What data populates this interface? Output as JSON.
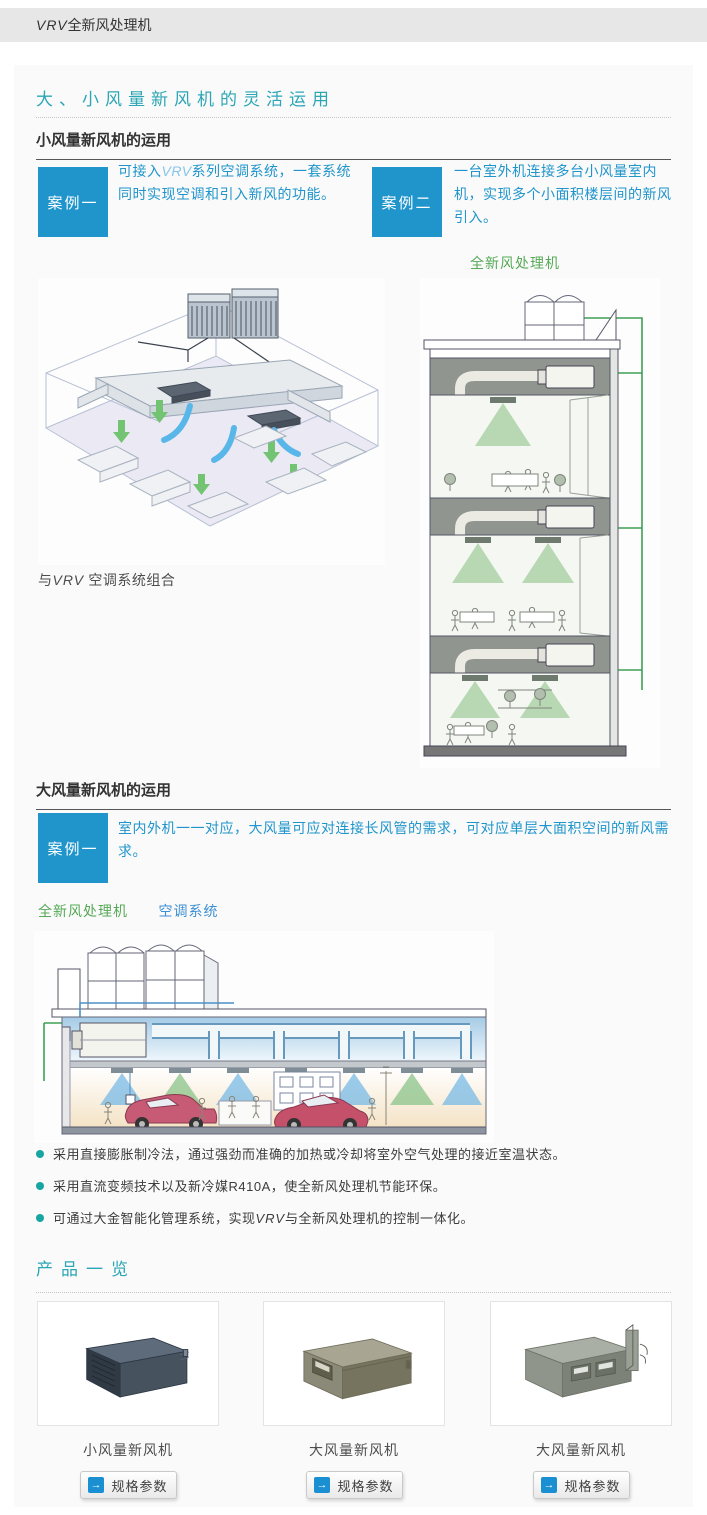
{
  "header": {
    "brand": "VRV",
    "title_rest": "全新风处理机"
  },
  "colors": {
    "accent_teal": "#2ca6b5",
    "case_blue": "#2095cc",
    "label_green": "#57a957",
    "label_blue": "#3c8fd2",
    "bullet_teal": "#18a5a2",
    "topbar_bg": "#e7e7e7",
    "card_bg": "#fafafa",
    "button_icon_blue": "#1a8fd1"
  },
  "icons": {
    "arrow_right": "→"
  },
  "main": {
    "title": "大、小风量新风机的灵活运用",
    "section_small": {
      "heading": "小风量新风机的运用",
      "case1": {
        "label": "案例一",
        "text_prefix": "可接入",
        "text_brand": "VRV",
        "text_suffix": "系列空调系统，一套系统同时实现空调和引入新风的功能。"
      },
      "case2": {
        "label": "案例二",
        "text": "一台室外机连接多台小风量室内机，实现多个小面积楼层间的新风引入。"
      },
      "building_label": "全新风处理机",
      "office_caption_prefix": "与",
      "office_caption_brand": "VRV",
      "office_caption_suffix": " 空调系统组合"
    },
    "section_large": {
      "heading": "大风量新风机的运用",
      "case1": {
        "label": "案例一",
        "text": "室内外机一一对应，大风量可应对连接长风管的需求，可对应单层大面积空间的新风需求。"
      },
      "labels": {
        "fresh_air": "全新风处理机",
        "ac_system": "空调系统"
      }
    },
    "bullets": [
      {
        "text": "采用直接膨胀制冷法，通过强劲而准确的加热或冷却将室外空气处理的接近室温状态。"
      },
      {
        "text": "采用直流变频技术以及新冷媒R410A，使全新风处理机节能环保。"
      },
      {
        "prefix": "可通过大金智能化管理系统，实现",
        "brand": "VRV",
        "suffix": "与全新风处理机的控制一体化。"
      }
    ],
    "products": {
      "heading": "产品一览",
      "items": [
        {
          "name": "小风量新风机",
          "button": "规格参数"
        },
        {
          "name": "大风量新风机",
          "button": "规格参数"
        },
        {
          "name": "大风量新风机",
          "button": "规格参数"
        }
      ]
    }
  }
}
